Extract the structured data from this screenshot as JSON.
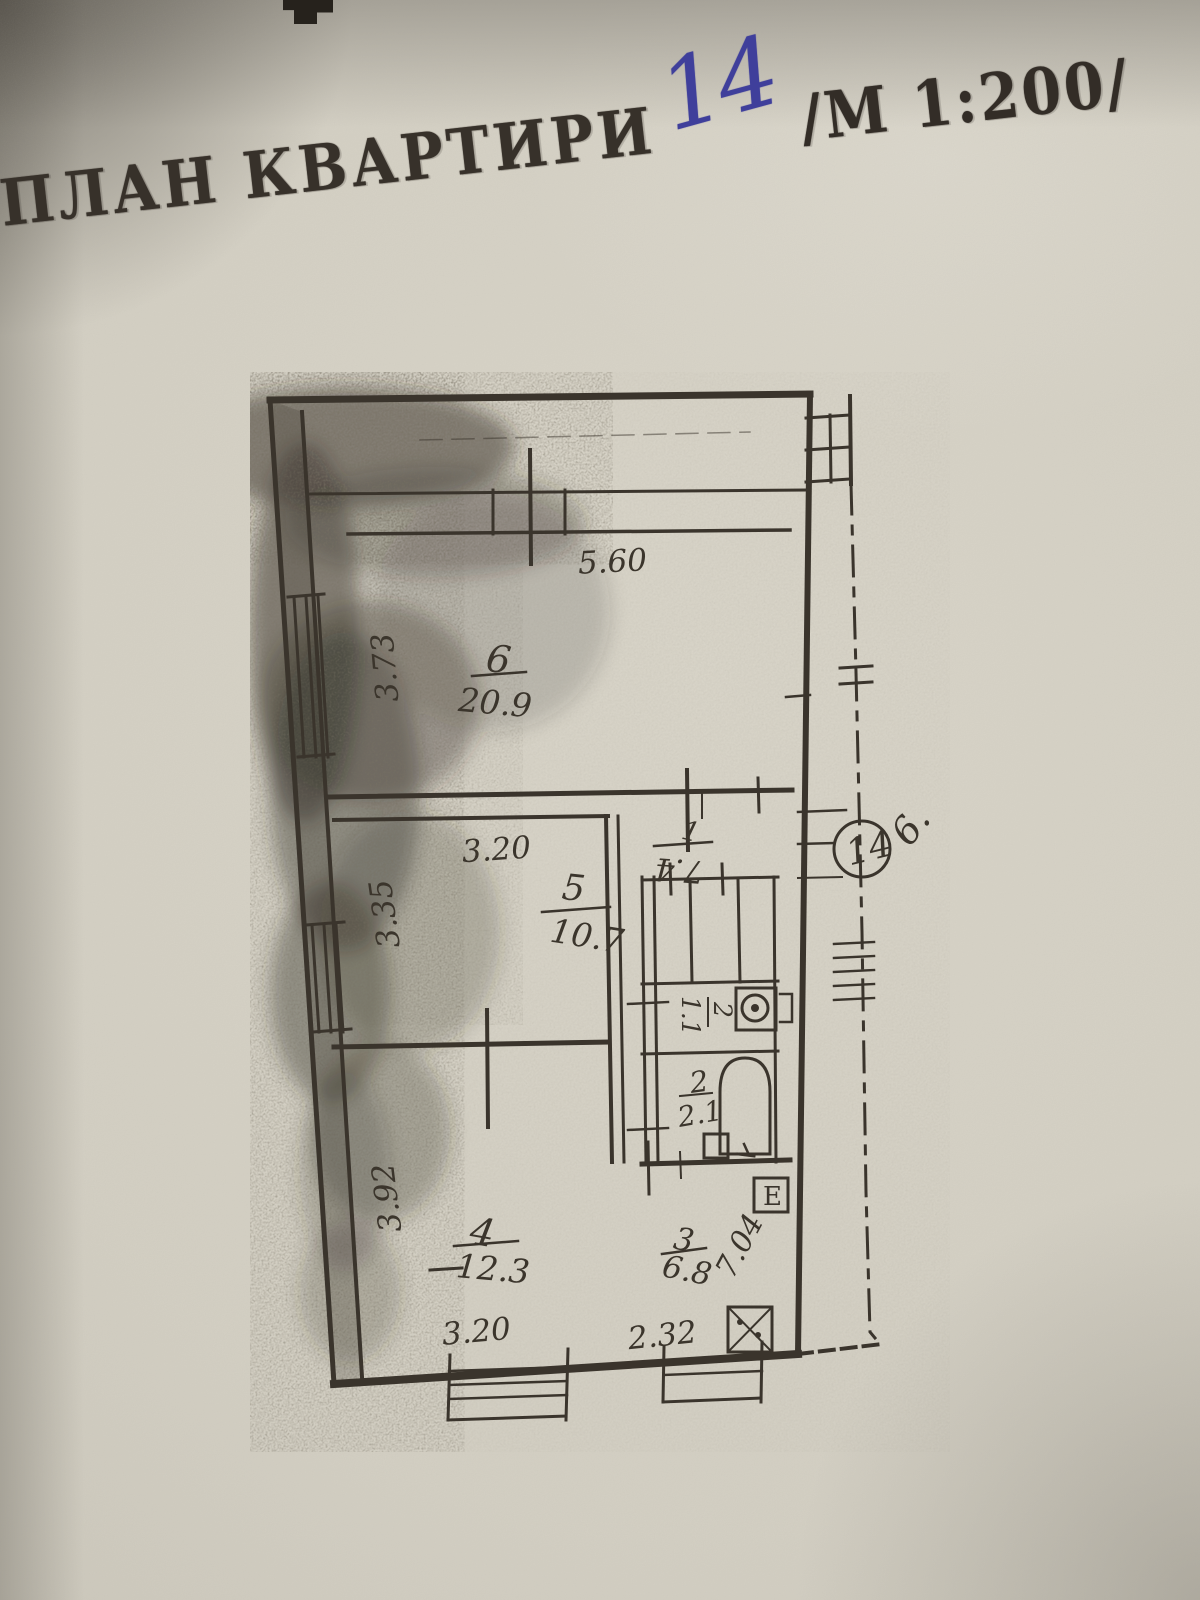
{
  "stamp": {
    "title": "ПЛАН КВАРТИРИ",
    "apartment_number": "14",
    "scale": "/М  1:200/"
  },
  "plan": {
    "badge_number": "14",
    "side_note": "6.",
    "kitchen_note": "7.04",
    "rooms": {
      "room6": {
        "number": "6",
        "area": "20.9"
      },
      "room5": {
        "number": "5",
        "area": "10.7"
      },
      "room4": {
        "number": "4",
        "area": "12.3"
      },
      "kitchen": {
        "number": "3",
        "area": "6.8"
      },
      "bath": {
        "number": "2",
        "area": "2.1"
      },
      "toilet": {
        "number": "2",
        "area": "1.1"
      },
      "corridor": {
        "number": "1",
        "area": "7.4"
      }
    },
    "dimensions": {
      "room6_width": "5.60",
      "room6_depth": "3.73",
      "room5_width": "3.20",
      "room5_depth": "3.35",
      "room4_depth": "3.92",
      "room4_width": "3.20",
      "kitchen_width": "2.32"
    },
    "stove_label": "Е"
  },
  "colors": {
    "ink": "#37312a",
    "pen_blue": "#3f3f9b",
    "paper": "#d3cfc3",
    "plan_line": "#3a342c"
  }
}
